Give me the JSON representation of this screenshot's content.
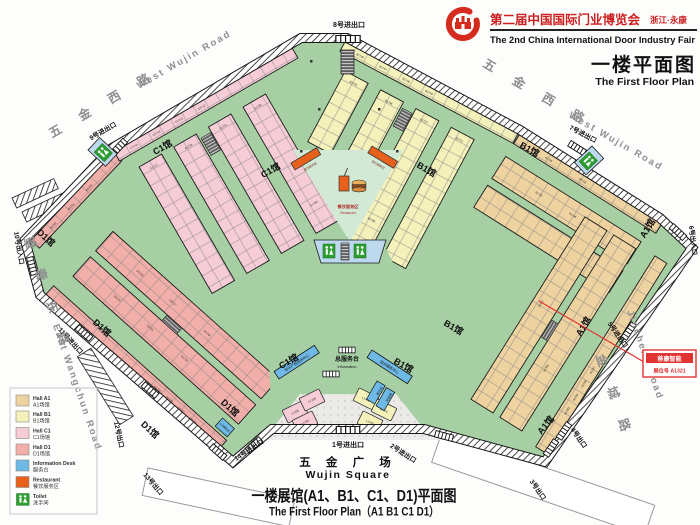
{
  "header": {
    "fair_title_cn": "第二届中国国际门业博览会",
    "fair_location": "浙江·永康",
    "fair_title_en": "The 2nd China International Door Industry Fair",
    "plan_title_cn": "一楼平面图",
    "plan_title_en": "The First Floor Plan"
  },
  "footer": {
    "square_cn": "五 金 广 场",
    "square_en": "Wujin Square",
    "caption_cn": "一楼展馆(A1、B1、C1、D1)平面图",
    "caption_en": "The First Floor Plan（A1 B1 C1 D1）"
  },
  "roads": {
    "west_wujin_cn": "五 金 西 路",
    "west_wujin_en": "West Wujin Road",
    "east_wangchun_cn": "望 春 东 路",
    "east_wangchun_en": "East Wangchun Road",
    "jincheng_cn": "金 城 路",
    "jincheng_en": "Jincheng Road"
  },
  "exits": {
    "e1": "1号进出口",
    "e2": "2号进出口",
    "e3": "3号出口",
    "e4": "4号出口",
    "e5": "5号进出口",
    "e6": "6号出入口",
    "e7": "7号进出口",
    "e8": "8号进出口",
    "e9": "9号进出口",
    "e10": "10号出入口",
    "e11": "11号进出口",
    "e12": "12号出口",
    "e13": "13号出口",
    "e14": "14号进出口"
  },
  "halls": {
    "a1": {
      "label": "A1馆",
      "booths": [
        "A1703",
        "A1704",
        "A1705",
        "A1707",
        "A1708",
        "A1725",
        "A1726",
        "A1735",
        "A1736",
        "A1321"
      ]
    },
    "b1": {
      "label": "B1馆",
      "booths": [
        "B1746",
        "B1747",
        "B1748",
        "B1749",
        "B1750",
        "B1751",
        "B1752",
        "B1753",
        "B1754",
        "B1755",
        "B1756",
        "B1757",
        "B1758",
        "B1759",
        "B1760",
        "B1743",
        "B1742",
        "B1741",
        "B1736",
        "B1727",
        "B1726",
        "B1717",
        "B1716",
        "B1711",
        "B1786",
        "B1785",
        "B1784",
        "B1783",
        "B1782"
      ]
    },
    "c1": {
      "label": "C1馆",
      "booths": [
        "C1714",
        "C1715",
        "C1713",
        "C1712",
        "C1711",
        "C1710",
        "C1709",
        "C1708",
        "C1717",
        "C1718",
        "C1719",
        "C1720",
        "C1721",
        "C1736",
        "C1737",
        "C1738",
        "C1735",
        "C1734",
        "C1733",
        "C1741",
        "C1742",
        "C1743",
        "C1745",
        "C1746",
        "C1747",
        "C1748",
        "C1749"
      ]
    },
    "d1": {
      "label": "D1馆",
      "booths": [
        "D1709",
        "D1708",
        "D1707",
        "D1706",
        "D1750",
        "D1751",
        "D1782",
        "D1781",
        "D1780",
        "D1730",
        "D1728",
        "D1717",
        "D1718",
        "D1719",
        "D1727",
        "D1729",
        "D1748",
        "D1749"
      ]
    },
    "lobby_booths": [
      "L1706",
      "L1705",
      "L1703",
      "L1702",
      "L1701",
      "L1707"
    ]
  },
  "services": {
    "restaurant_cn": "餐饮服务区",
    "restaurant_en": "Restaurant",
    "info_main_cn": "总服务台",
    "info_main_en": "Information",
    "ipr_desk": "知识产权投诉中心",
    "complaint_desk": "投诉服务中心",
    "office": "办公室",
    "service_desk": "服务台",
    "d1_desk": "D1馆服务台",
    "toilet_cn": "洗手间",
    "toilet_en": "Toilet"
  },
  "callout": {
    "company": "移康智能",
    "booth": "展位号 A1321"
  },
  "legend": {
    "items": [
      {
        "en": "Hall A1",
        "cn": "A1场馆",
        "color": "#eed2a0"
      },
      {
        "en": "Hall B1",
        "cn": "B1场馆",
        "color": "#f4f1bb"
      },
      {
        "en": "Hall C1",
        "cn": "C1场馆",
        "color": "#f6ccd7"
      },
      {
        "en": "Hall D1",
        "cn": "D1场馆",
        "color": "#f2aea8"
      },
      {
        "en": "Information Desk",
        "cn": "服务台",
        "color": "#6fb9e6"
      },
      {
        "en": "Restaurant",
        "cn": "餐饮服务区",
        "color": "#e8611c"
      },
      {
        "en": "Toilet",
        "cn": "洗手间",
        "color": "#2e9e33"
      }
    ]
  },
  "colors": {
    "brand_red": "#cc1f1f",
    "callout_red": "#e23333",
    "floor_green": "#a6d0a4",
    "courtyard_green": "#d2ead5",
    "info_blue": "#6fb9e6",
    "restaurant_orange": "#e8611c",
    "toilet_green": "#2e9e33"
  }
}
